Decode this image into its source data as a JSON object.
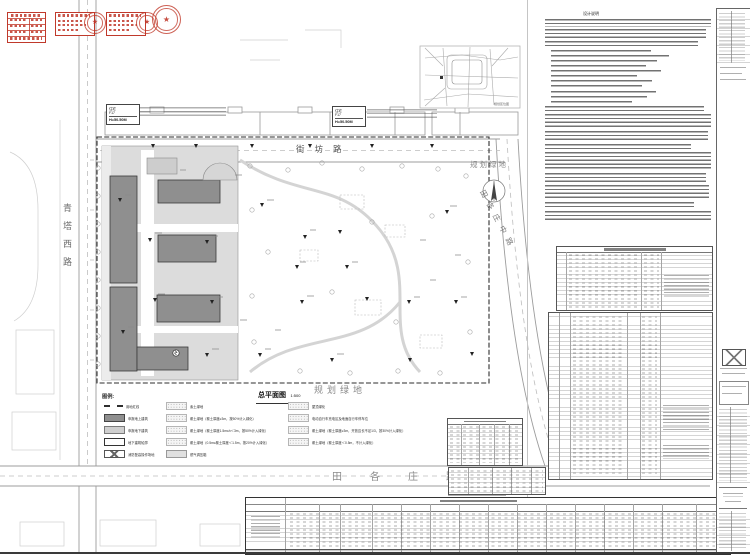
{
  "titles": {
    "plan": "总平面图",
    "scale": "1:500",
    "notes": "设计说明",
    "inset": "规划区位图"
  },
  "roads": {
    "west": "青塔西路",
    "inner_north": "街坊路",
    "south": "田各庄路",
    "east": "田各庄中路"
  },
  "green": {
    "east": "规划绿地",
    "south": "规划绿地"
  },
  "tag": {
    "use": "住宅",
    "floors": "F17",
    "height": "H=50.50M"
  },
  "legend": {
    "title": "图例:",
    "col1": [
      "用地红线",
      "申报地上建筑",
      "申报地下建筑",
      "地下建筑轮廓",
      "消防登高操作场地"
    ],
    "col2": [
      "素土绿地",
      "覆土绿地（覆土厚度≥3m，按50%计入绿化）",
      "覆土绿地（覆土厚度1.5m≤h＜3m，按50%计入绿化）",
      "覆土绿地（0.5m≤覆土厚度＜1.5m，按20%计入绿化）",
      "燃气调压箱"
    ],
    "col3": [
      "屋顶绿化",
      "电动自行车充电区及地面自行车停车位",
      "覆土绿地（覆土厚度≥3m，开放边长不足1/3，按30%计入绿化）",
      "覆土绿地（覆土厚度＜0.5m，不计入绿化）"
    ]
  },
  "colors": {
    "stamp_red": "#c0392b",
    "building_above": "#8f8f8f",
    "building_below": "#dcdcdc",
    "line_dark": "#2e2e2e",
    "line_faint": "#c9c9c9"
  }
}
